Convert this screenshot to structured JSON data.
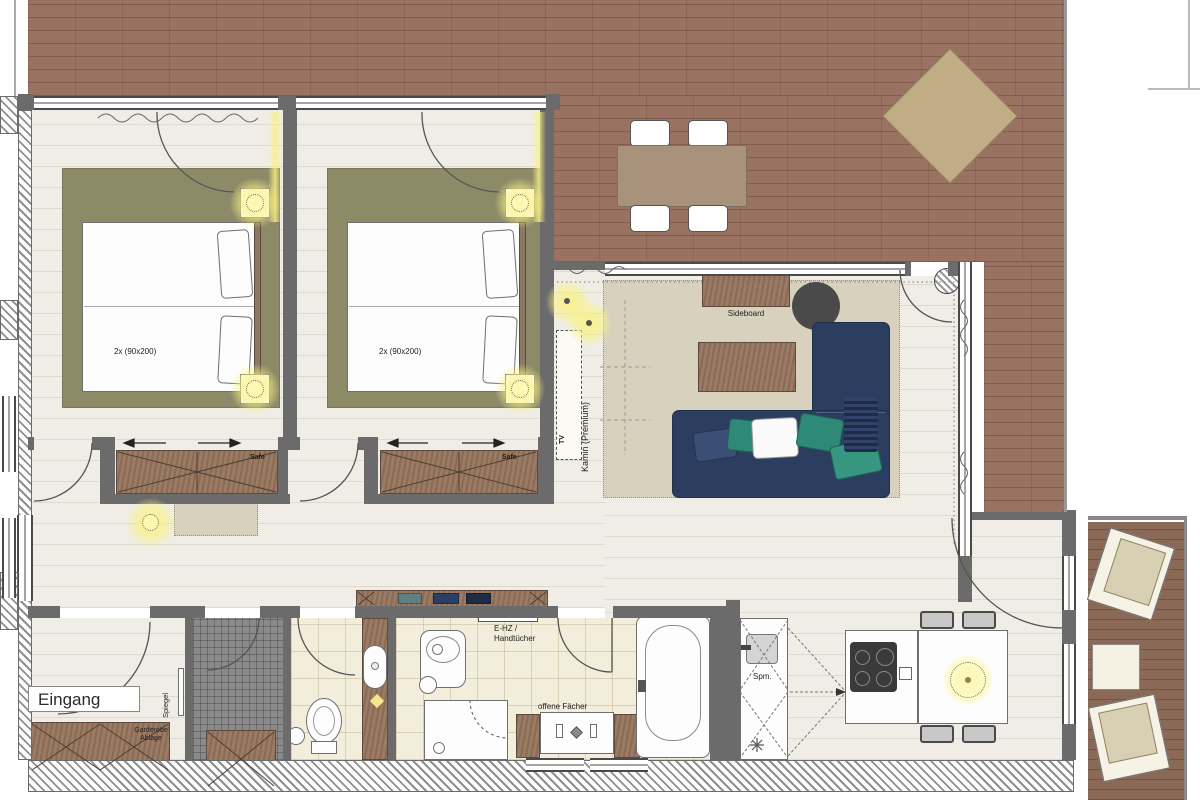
{
  "labels": {
    "entrance": "Eingang",
    "mirror": "Spiegel",
    "wardrobe_line1": "Garderobe",
    "wardrobe_line2": "Ablage",
    "bedroom1_bed": "2x (90x200)",
    "bedroom1_safe": "Safe",
    "bedroom2_bed": "2x (90x200)",
    "bedroom2_safe": "Safe",
    "living_sideboard": "Sideboard",
    "living_fireplace": "Kamin (Premium)",
    "living_tv": "TV",
    "bath_heater_line1": "E-HZ /",
    "bath_heater_line2": "Handtücher",
    "bath_shelves": "offene Fächer",
    "kitchen_dishwasher": "Spm."
  },
  "colors": {
    "terrace_brick": "#9a7262",
    "balcony_wood": "#8a6a57",
    "interior_floor": "#efede5",
    "bathroom_tile": "#f3eddc",
    "utility_tile": "#8a8a8a",
    "bedroom_rug": "#8d8a68",
    "living_rug": "#d8d1bd",
    "sofa_navy": "#2b3e60",
    "pillow_teal": "#2e8a76",
    "furniture_wood": "#9b7b64",
    "outdoor_furniture": "#a8927b",
    "lounger_tan": "#c0ad86",
    "wall_grey": "#6b6b6b",
    "lamp_glow": "#f7f282",
    "cooktop_dark": "#3a3a3a"
  }
}
